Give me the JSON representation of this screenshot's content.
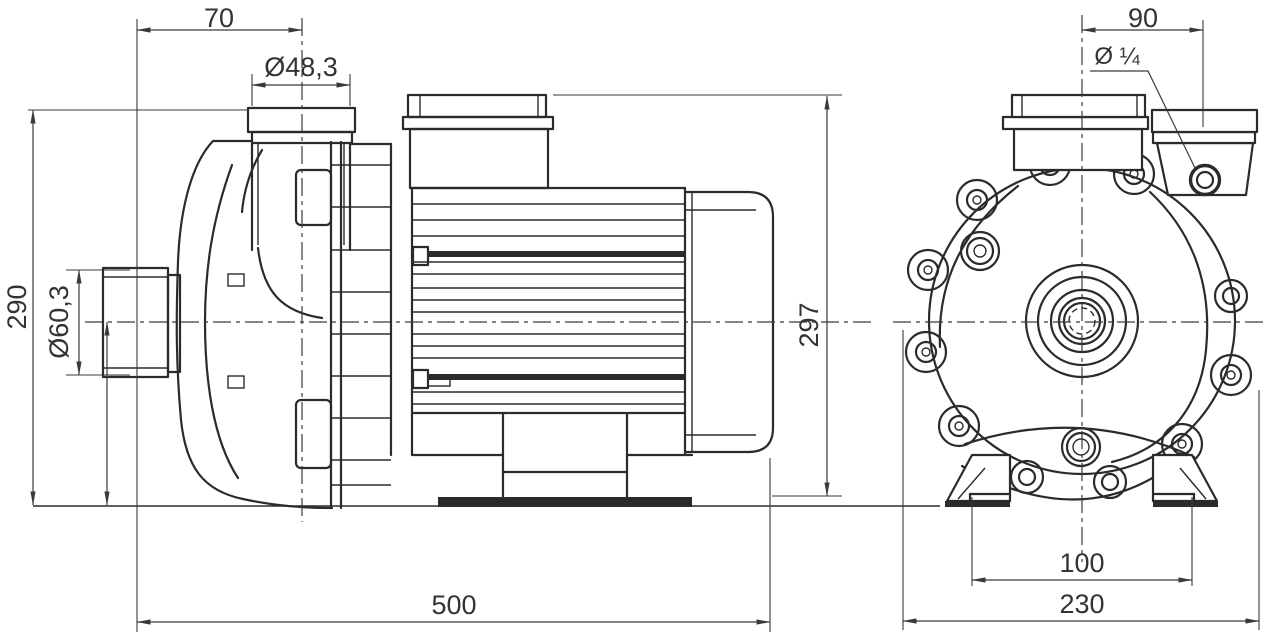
{
  "drawing": {
    "kind": "pump-dimensional-drawing",
    "style": {
      "line_color": "#2b2b2b",
      "dim_color": "#3a3a3a",
      "background": "#ffffff"
    },
    "dimensions": {
      "side_view": {
        "discharge_port_offset": "70",
        "discharge_pipe_od": "Ø48,3",
        "overall_height": "290",
        "suction_pipe_od": "Ø60,3",
        "overall_length": "500",
        "motor_top_height": "297"
      },
      "front_view": {
        "discharge_port_offset": "90",
        "drain_plug_size": "Ø ¼",
        "foot_hole_spacing": "100",
        "overall_width": "230"
      }
    }
  }
}
